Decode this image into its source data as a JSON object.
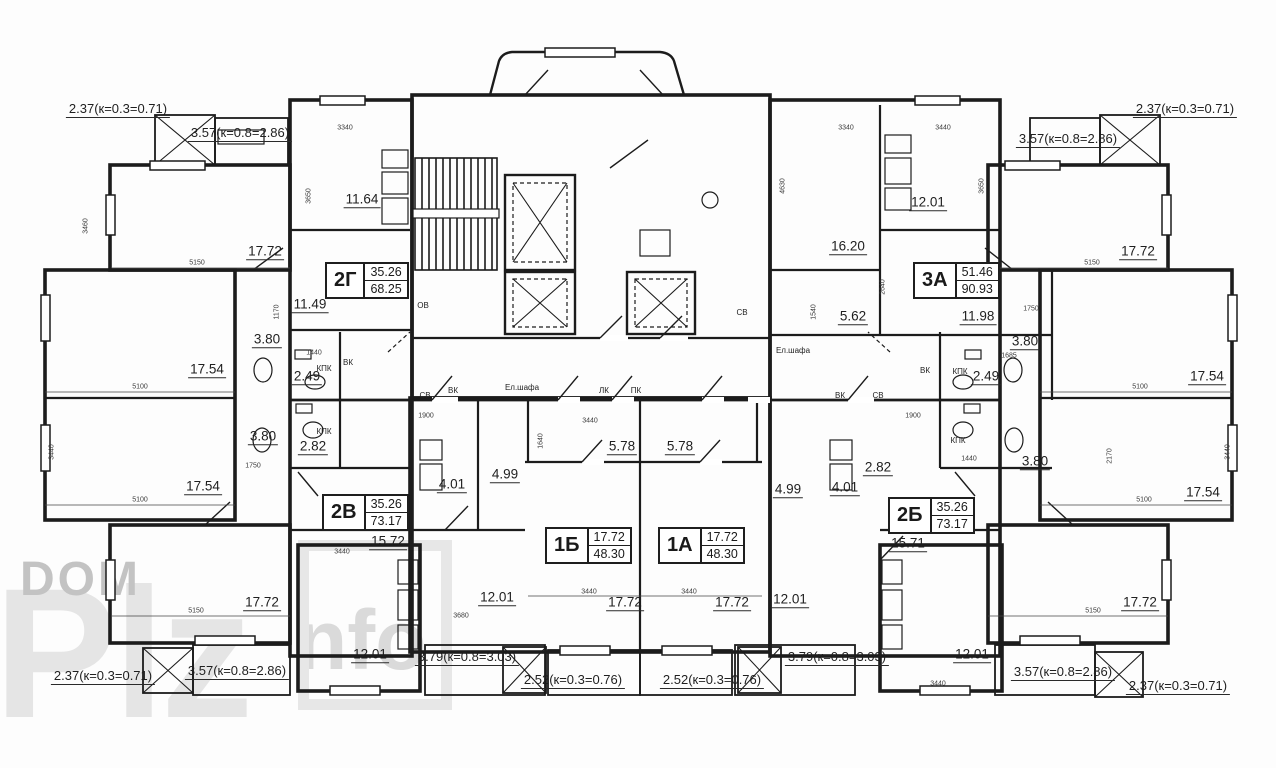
{
  "watermark": {
    "line1": "DOM",
    "big": "Plz",
    "small": "nfo"
  },
  "apartments": [
    {
      "name": "2Г",
      "area_living": "35.26",
      "area_total": "68.25"
    },
    {
      "name": "3А",
      "area_living": "51.46",
      "area_total": "90.93"
    },
    {
      "name": "2В",
      "area_living": "35.26",
      "area_total": "73.17"
    },
    {
      "name": "1Б",
      "area_living": "17.72",
      "area_total": "48.30"
    },
    {
      "name": "1А",
      "area_living": "17.72",
      "area_total": "48.30"
    },
    {
      "name": "2Б",
      "area_living": "35.26",
      "area_total": "73.17"
    }
  ],
  "room_areas": [
    {
      "text": "17.72",
      "x": 265,
      "y": 252
    },
    {
      "text": "11.64",
      "x": 362,
      "y": 200
    },
    {
      "text": "11.49",
      "x": 310,
      "y": 305
    },
    {
      "text": "3.80",
      "x": 267,
      "y": 340
    },
    {
      "text": "2.49",
      "x": 307,
      "y": 377
    },
    {
      "text": "17.54",
      "x": 207,
      "y": 370
    },
    {
      "text": "3.80",
      "x": 263,
      "y": 437
    },
    {
      "text": "2.82",
      "x": 313,
      "y": 447
    },
    {
      "text": "17.54",
      "x": 203,
      "y": 487
    },
    {
      "text": "4.01",
      "x": 452,
      "y": 485
    },
    {
      "text": "4.99",
      "x": 505,
      "y": 475
    },
    {
      "text": "15.72",
      "x": 388,
      "y": 542
    },
    {
      "text": "17.72",
      "x": 262,
      "y": 603
    },
    {
      "text": "12.01",
      "x": 370,
      "y": 655
    },
    {
      "text": "12.01",
      "x": 497,
      "y": 598
    },
    {
      "text": "5.78",
      "x": 622,
      "y": 447
    },
    {
      "text": "5.78",
      "x": 680,
      "y": 447
    },
    {
      "text": "17.72",
      "x": 625,
      "y": 603
    },
    {
      "text": "17.72",
      "x": 732,
      "y": 603
    },
    {
      "text": "12.01",
      "x": 790,
      "y": 600
    },
    {
      "text": "4.99",
      "x": 788,
      "y": 490
    },
    {
      "text": "4.01",
      "x": 845,
      "y": 488
    },
    {
      "text": "2.82",
      "x": 878,
      "y": 468
    },
    {
      "text": "15.71",
      "x": 908,
      "y": 544
    },
    {
      "text": "16.20",
      "x": 848,
      "y": 247
    },
    {
      "text": "12.01",
      "x": 928,
      "y": 203
    },
    {
      "text": "5.62",
      "x": 853,
      "y": 317
    },
    {
      "text": "11.98",
      "x": 978,
      "y": 317
    },
    {
      "text": "3.80",
      "x": 1025,
      "y": 342
    },
    {
      "text": "2.49",
      "x": 986,
      "y": 377
    },
    {
      "text": "17.54",
      "x": 1207,
      "y": 377
    },
    {
      "text": "3.80",
      "x": 1035,
      "y": 462
    },
    {
      "text": "17.54",
      "x": 1203,
      "y": 493
    },
    {
      "text": "17.72",
      "x": 1138,
      "y": 252
    },
    {
      "text": "17.72",
      "x": 1140,
      "y": 603
    },
    {
      "text": "12.01",
      "x": 972,
      "y": 655
    }
  ],
  "balcony_labels": [
    {
      "text": "2.37(к=0.3=0.71)",
      "x": 118,
      "y": 110
    },
    {
      "text": "3.57(к=0.8=2.86)",
      "x": 240,
      "y": 134
    },
    {
      "text": "2.37(к=0.3=0.71)",
      "x": 1185,
      "y": 110
    },
    {
      "text": "3.57(к=0.8=2.86)",
      "x": 1068,
      "y": 140
    },
    {
      "text": "2.37(к=0.3=0.71)",
      "x": 103,
      "y": 677
    },
    {
      "text": "3.57(к=0.8=2.86)",
      "x": 237,
      "y": 672
    },
    {
      "text": "3.79(к=0.8=3.03)",
      "x": 467,
      "y": 658
    },
    {
      "text": "2.52(к=0.3=0.76)",
      "x": 573,
      "y": 681
    },
    {
      "text": "2.52(к=0.3=0.76)",
      "x": 712,
      "y": 681
    },
    {
      "text": "3.79(к=0.8=3.03)",
      "x": 837,
      "y": 658
    },
    {
      "text": "3.57(к=0.8=2.86)",
      "x": 1063,
      "y": 673
    },
    {
      "text": "2.37(к=0.3=0.71)",
      "x": 1178,
      "y": 687
    }
  ],
  "service_labels": [
    {
      "text": "КПК",
      "x": 324,
      "y": 369
    },
    {
      "text": "КПК",
      "x": 324,
      "y": 432
    },
    {
      "text": "ВК",
      "x": 348,
      "y": 363
    },
    {
      "text": "ОВ",
      "x": 423,
      "y": 306
    },
    {
      "text": "СВ",
      "x": 425,
      "y": 396
    },
    {
      "text": "ВК",
      "x": 453,
      "y": 391
    },
    {
      "text": "Ел.шафа",
      "x": 522,
      "y": 388
    },
    {
      "text": "ЛК",
      "x": 604,
      "y": 391
    },
    {
      "text": "ПК",
      "x": 636,
      "y": 391
    },
    {
      "text": "СВ",
      "x": 742,
      "y": 313
    },
    {
      "text": "Ел.шафа",
      "x": 793,
      "y": 351
    },
    {
      "text": "ВК",
      "x": 840,
      "y": 396
    },
    {
      "text": "СВ",
      "x": 878,
      "y": 396
    },
    {
      "text": "ВК",
      "x": 925,
      "y": 371
    },
    {
      "text": "КПК",
      "x": 960,
      "y": 372
    },
    {
      "text": "КПК",
      "x": 958,
      "y": 441
    }
  ],
  "dimensions": [
    {
      "text": "5150",
      "x": 197,
      "y": 263
    },
    {
      "text": "3340",
      "x": 345,
      "y": 128
    },
    {
      "text": "3650",
      "x": 309,
      "y": 196,
      "v": true
    },
    {
      "text": "3460",
      "x": 86,
      "y": 226,
      "v": true
    },
    {
      "text": "5100",
      "x": 140,
      "y": 387
    },
    {
      "text": "3440",
      "x": 52,
      "y": 452,
      "v": true
    },
    {
      "text": "5100",
      "x": 140,
      "y": 500
    },
    {
      "text": "5150",
      "x": 196,
      "y": 611
    },
    {
      "text": "1170",
      "x": 277,
      "y": 312,
      "v": true
    },
    {
      "text": "1440",
      "x": 314,
      "y": 353
    },
    {
      "text": "1750",
      "x": 253,
      "y": 466
    },
    {
      "text": "1900",
      "x": 426,
      "y": 416
    },
    {
      "text": "3440",
      "x": 590,
      "y": 421
    },
    {
      "text": "1640",
      "x": 541,
      "y": 441,
      "v": true
    },
    {
      "text": "3440",
      "x": 589,
      "y": 592
    },
    {
      "text": "3440",
      "x": 689,
      "y": 592
    },
    {
      "text": "3680",
      "x": 461,
      "y": 616
    },
    {
      "text": "3440",
      "x": 342,
      "y": 552
    },
    {
      "text": "3340",
      "x": 846,
      "y": 128
    },
    {
      "text": "3440",
      "x": 943,
      "y": 128
    },
    {
      "text": "4630",
      "x": 783,
      "y": 186,
      "v": true
    },
    {
      "text": "3650",
      "x": 982,
      "y": 186,
      "v": true
    },
    {
      "text": "2640",
      "x": 883,
      "y": 287,
      "v": true
    },
    {
      "text": "1540",
      "x": 814,
      "y": 312,
      "v": true
    },
    {
      "text": "1750",
      "x": 1031,
      "y": 309
    },
    {
      "text": "1685",
      "x": 1009,
      "y": 356
    },
    {
      "text": "1440",
      "x": 969,
      "y": 459
    },
    {
      "text": "1900",
      "x": 913,
      "y": 416
    },
    {
      "text": "5100",
      "x": 1140,
      "y": 387
    },
    {
      "text": "5100",
      "x": 1144,
      "y": 500
    },
    {
      "text": "3440",
      "x": 1228,
      "y": 452,
      "v": true
    },
    {
      "text": "5150",
      "x": 1092,
      "y": 263
    },
    {
      "text": "5150",
      "x": 1093,
      "y": 611
    },
    {
      "text": "3440",
      "x": 938,
      "y": 684
    },
    {
      "text": "2170",
      "x": 1110,
      "y": 456,
      "v": true
    }
  ]
}
